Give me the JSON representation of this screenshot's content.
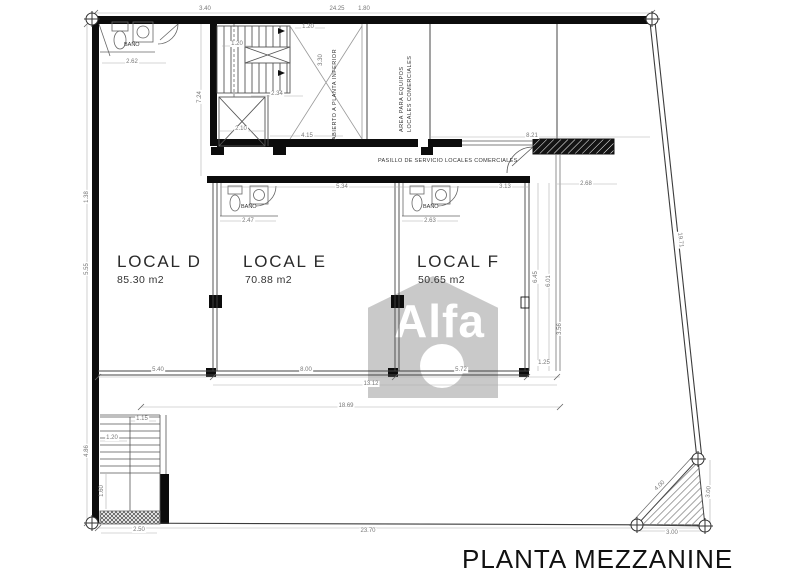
{
  "title": "PLANTA MEZZANINE",
  "watermark": "Alfa",
  "locals": [
    {
      "name": "LOCAL D",
      "area": "85.30 m2"
    },
    {
      "name": "LOCAL E",
      "area": "70.88 m2"
    },
    {
      "name": "LOCAL F",
      "area": "50.65 m2"
    }
  ],
  "labels": {
    "pasillo": "PASILLO DE SERVICIO LOCALES COMERCIALES",
    "abierto": "ABIERTO A PLANTA INFERIOR",
    "equipos_line1": "AREA PARA EQUIPOS",
    "equipos_line2": "LOCALES COMERCIALES",
    "bano": "BAÑO"
  },
  "dimensions": [
    {
      "text": "3.40",
      "x": 205,
      "y": 9,
      "rot": 0
    },
    {
      "text": "24.25",
      "x": 337,
      "y": 9,
      "rot": 0
    },
    {
      "text": "1.80",
      "x": 364,
      "y": 9,
      "rot": 0
    },
    {
      "text": "1.20",
      "x": 237,
      "y": 44,
      "rot": 0
    },
    {
      "text": "1.20",
      "x": 308,
      "y": 27,
      "rot": 0
    },
    {
      "text": "2.34",
      "x": 277,
      "y": 94,
      "rot": 0
    },
    {
      "text": "2.10",
      "x": 241,
      "y": 129,
      "rot": 0
    },
    {
      "text": "4.15",
      "x": 307,
      "y": 136,
      "rot": 0
    },
    {
      "text": "7.24",
      "x": 200,
      "y": 97,
      "rot": -90
    },
    {
      "text": "3.30",
      "x": 321,
      "y": 60,
      "rot": -90
    },
    {
      "text": "2.62",
      "x": 132,
      "y": 62,
      "rot": 0
    },
    {
      "text": "5.34",
      "x": 342,
      "y": 187,
      "rot": 0
    },
    {
      "text": "3.13",
      "x": 505,
      "y": 187,
      "rot": 0
    },
    {
      "text": "2.68",
      "x": 586,
      "y": 184,
      "rot": 0
    },
    {
      "text": "8.21",
      "x": 532,
      "y": 136,
      "rot": 0
    },
    {
      "text": "2.47",
      "x": 248,
      "y": 221,
      "rot": 0
    },
    {
      "text": "2.63",
      "x": 430,
      "y": 221,
      "rot": 0
    },
    {
      "text": "5.40",
      "x": 158,
      "y": 370,
      "rot": 0
    },
    {
      "text": "8.00",
      "x": 306,
      "y": 370,
      "rot": 0
    },
    {
      "text": "5.72",
      "x": 461,
      "y": 370,
      "rot": 0
    },
    {
      "text": "13.12",
      "x": 371,
      "y": 384,
      "rot": 0
    },
    {
      "text": "1.25",
      "x": 544,
      "y": 363,
      "rot": 0
    },
    {
      "text": "18.69",
      "x": 346,
      "y": 406,
      "rot": 0
    },
    {
      "text": "23.70",
      "x": 368,
      "y": 531,
      "rot": 0
    },
    {
      "text": "1.15",
      "x": 142,
      "y": 419,
      "rot": 0
    },
    {
      "text": "1.20",
      "x": 112,
      "y": 438,
      "rot": 0
    },
    {
      "text": "1.60",
      "x": 102,
      "y": 491,
      "rot": -90
    },
    {
      "text": "2.50",
      "x": 139,
      "y": 530,
      "rot": 0
    },
    {
      "text": "4.86",
      "x": 87,
      "y": 451,
      "rot": -90
    },
    {
      "text": "1.38",
      "x": 87,
      "y": 197,
      "rot": -90
    },
    {
      "text": "5.55",
      "x": 87,
      "y": 269,
      "rot": -90
    },
    {
      "text": "6.45",
      "x": 536,
      "y": 277,
      "rot": -90
    },
    {
      "text": "6.01",
      "x": 549,
      "y": 281,
      "rot": -90
    },
    {
      "text": "3.56",
      "x": 560,
      "y": 329,
      "rot": -90
    },
    {
      "text": "4.00",
      "x": 660,
      "y": 486,
      "rot": -43
    },
    {
      "text": "3.00",
      "x": 672,
      "y": 533,
      "rot": 0
    },
    {
      "text": "3.00",
      "x": 709,
      "y": 492,
      "rot": -84
    },
    {
      "text": "19.71",
      "x": 680,
      "y": 240,
      "rot": 84
    }
  ]
}
